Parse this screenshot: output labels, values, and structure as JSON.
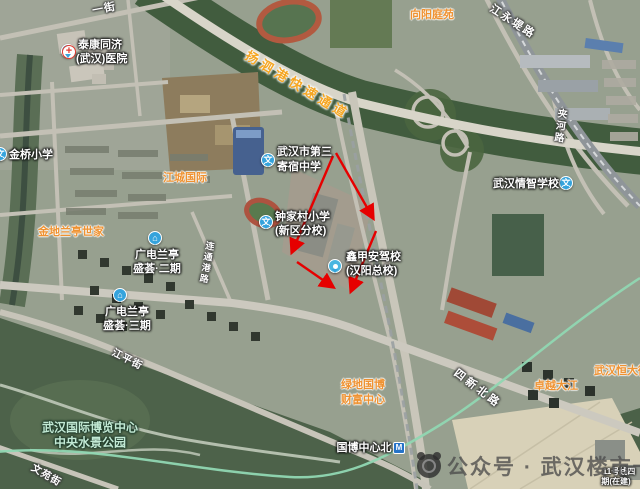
{
  "labels": {
    "hospital": {
      "line1": "泰康同济",
      "line2": "(武汉)医院"
    },
    "jinqiao_primary": "金桥小学",
    "xiangyang_tingyuan": "向阳庭苑",
    "no3_boarding": {
      "line1": "武汉市第三",
      "line2": "寄宿中学"
    },
    "jiangcheng_intl": "江城国际",
    "jindi_lanting": "金地兰亭世家",
    "zhongjiacun_primary": {
      "line1": "钟家村小学",
      "line2": "(新区分校)"
    },
    "guangdian_phase2": {
      "line1": "广电兰亭",
      "line2": "盛荟·二期"
    },
    "guangdian_phase3": {
      "line1": "广电兰亭",
      "line2": "盛荟·三期"
    },
    "qingzhi_school": "武汉情智学校",
    "driving_school": {
      "line1": "鑫甲安驾校",
      "line2": "(汉阳总校)"
    },
    "lvdi_guobo": {
      "line1": "绿地国博",
      "line2": "财富中心"
    },
    "zhuoyue_dajiang": "卓越大江",
    "hengda": "武汉恒大御",
    "expo_park": {
      "line1": "武汉国际博览中心",
      "line2": "中央水景公园"
    },
    "guobo_station": "国博中心北",
    "metro11": {
      "line1": "11号线四",
      "line2": "期(在建)"
    }
  },
  "roads": {
    "yangsigang": "扬泗港快速通道",
    "jiangyongdi": "江永堤路",
    "jiahe": "夹河路",
    "sixin_north": "四新北路",
    "jiangping": "江平街",
    "liantonggang": "连通港路",
    "wenyuan": "文苑街",
    "yijie": "一街"
  },
  "icons": {
    "school_glyph": "文",
    "metro_glyph": "M",
    "hospital_glyph": "+",
    "building_glyph": "⌂"
  },
  "watermark": {
    "text": "公众号 · 武汉楼市一线"
  },
  "annotation": {
    "color": "#e60000",
    "shape": "red-arrow-quadrilateral"
  },
  "colors": {
    "poi_orange": "#ef9231",
    "road_gold": "#f5a623",
    "park_label": "#c2e9d4"
  }
}
